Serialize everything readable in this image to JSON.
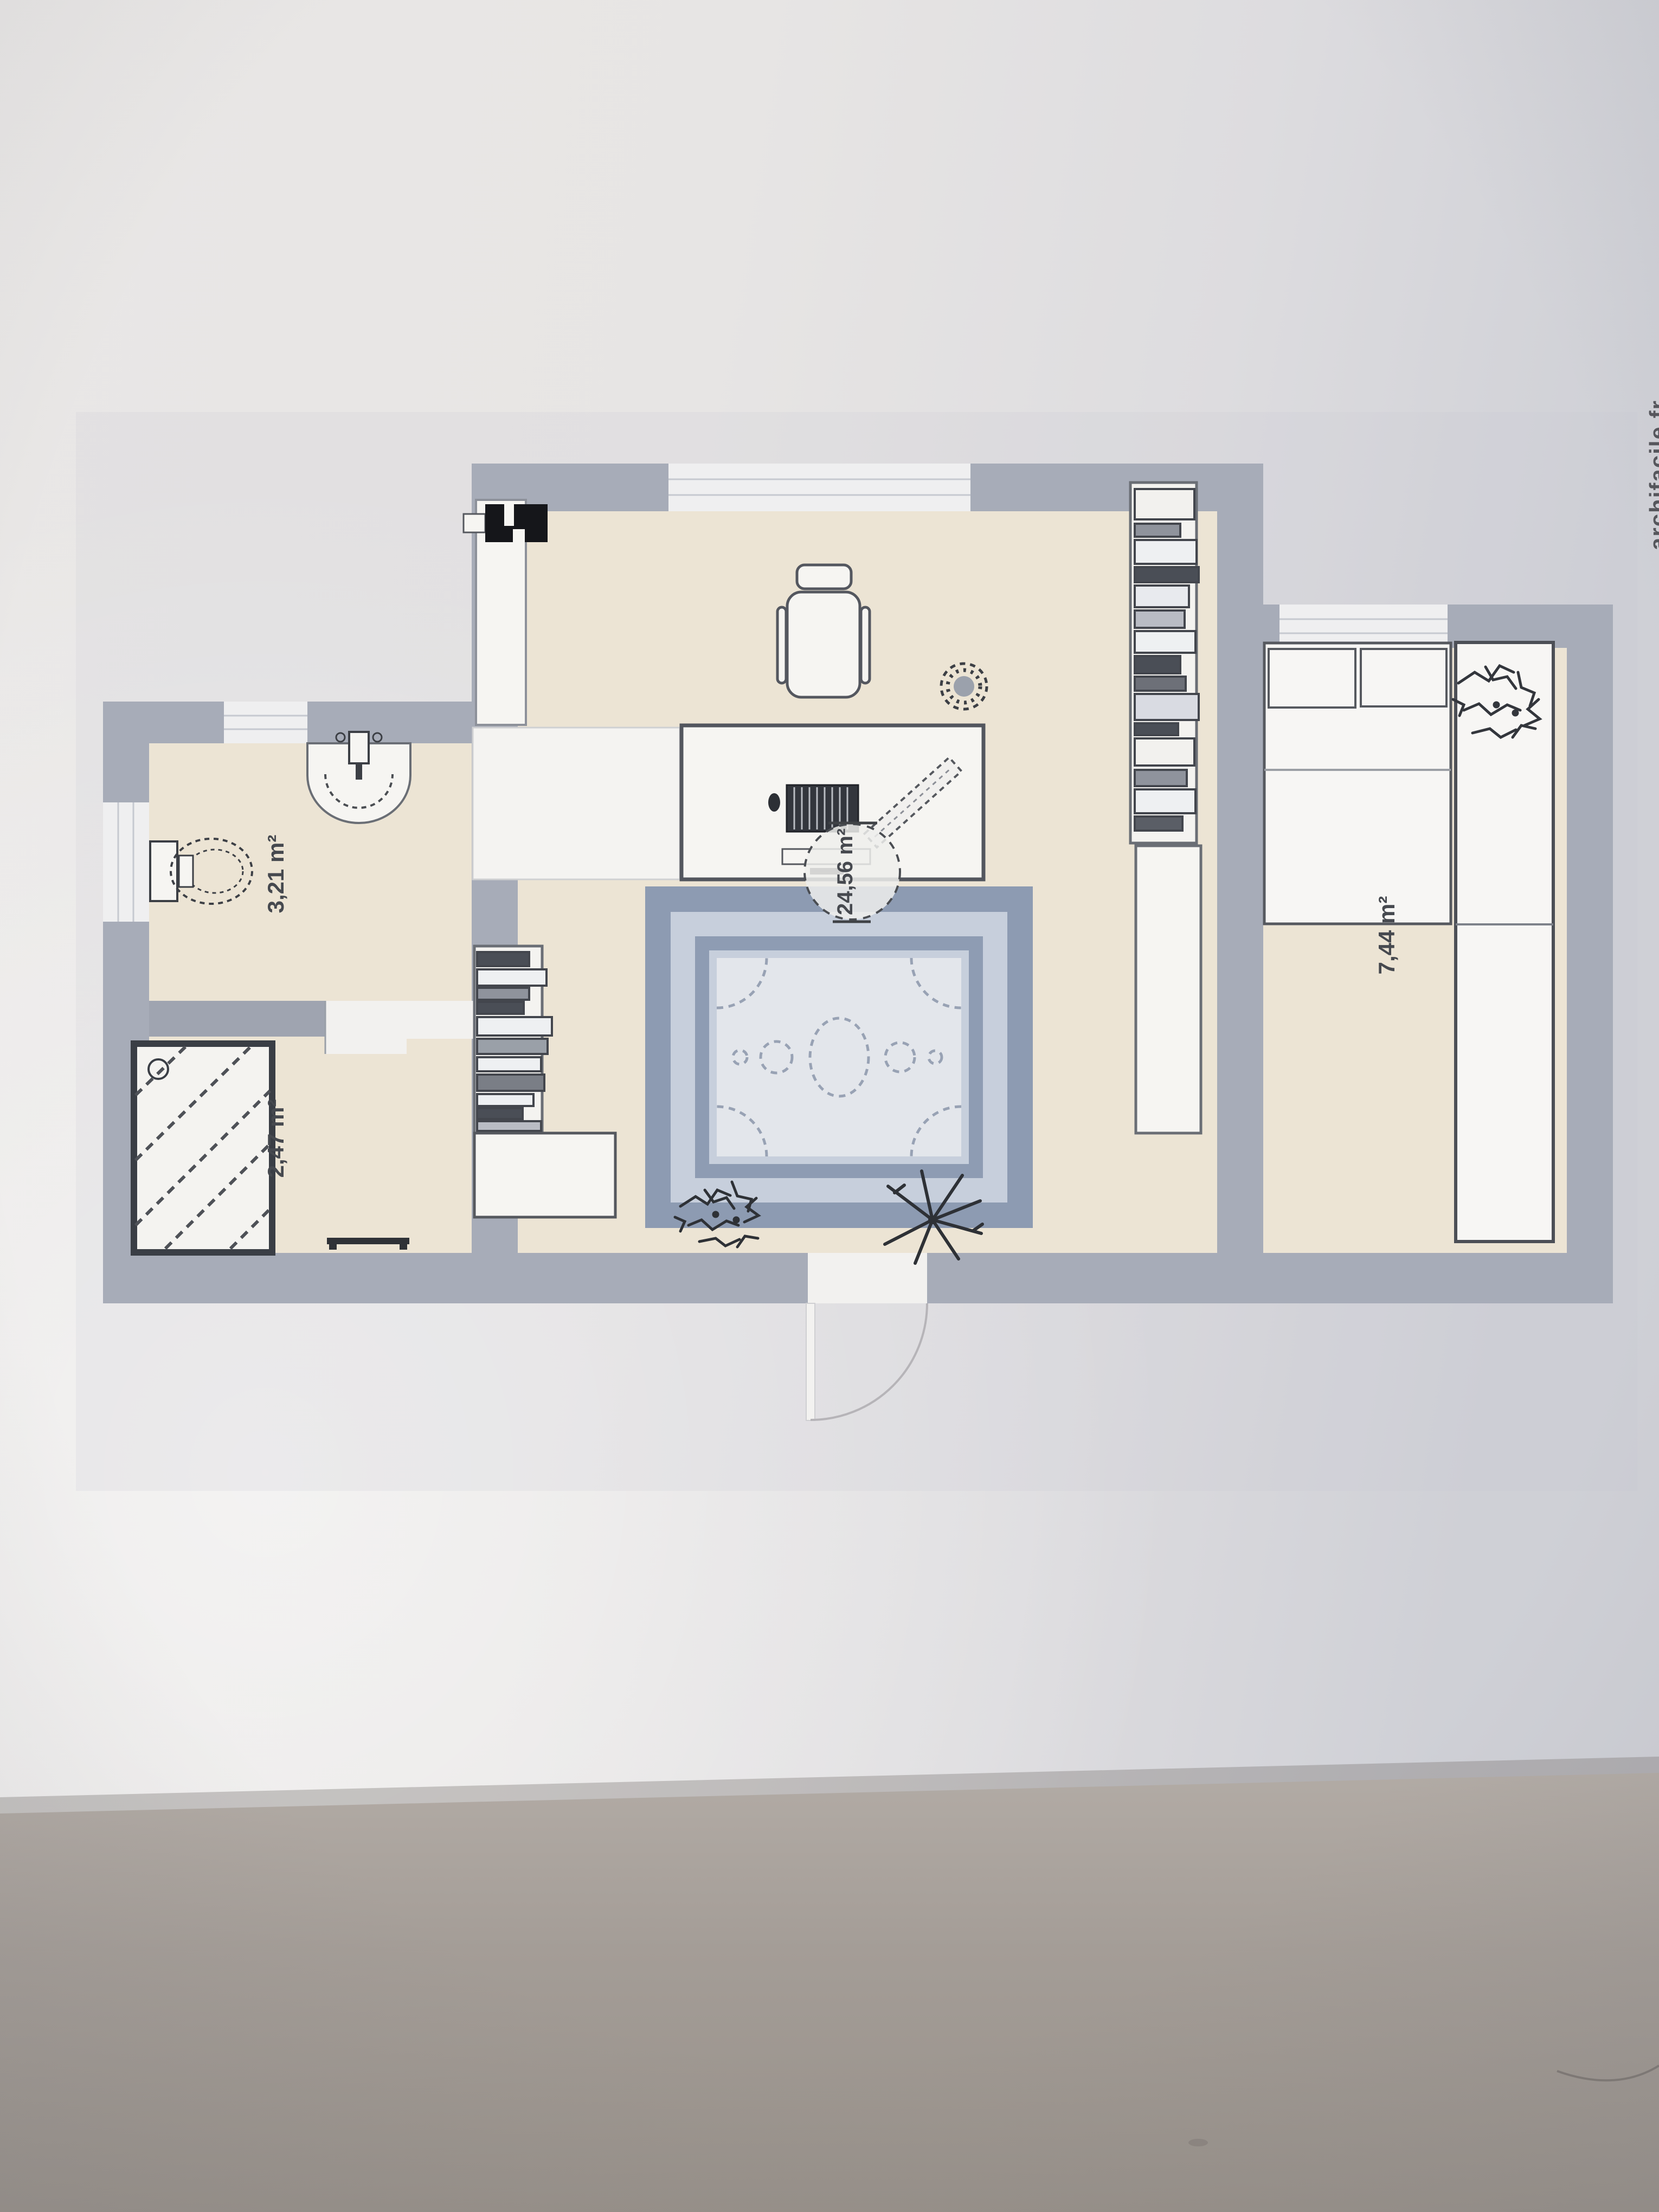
{
  "floor_plan": {
    "labels": {
      "living": "24,56 m²",
      "bathroom": "3,21 m²",
      "shower": "2,47 m²",
      "bedroom": "7,44 m²"
    },
    "watermark": "archifacile.fr",
    "rooms": [
      {
        "name": "living-room",
        "area_m2": 24.56
      },
      {
        "name": "bathroom",
        "area_m2": 3.21
      },
      {
        "name": "shower-room",
        "area_m2": 2.47
      },
      {
        "name": "bedroom",
        "area_m2": 7.44
      }
    ],
    "icons": [
      "tv-icon",
      "wardrobe-icon",
      "desk-icon",
      "office-chair-icon",
      "keyboard-icon",
      "monitor-icon",
      "mouse-icon",
      "ruler-icon",
      "fan-plant-icon",
      "bookshelf-icon",
      "cabinet-icon",
      "rug-icon",
      "plant-icon",
      "sink-icon",
      "toilet-icon",
      "shower-icon",
      "bench-icon",
      "bed-icon",
      "pillow-icon",
      "door-arc-icon"
    ],
    "colors": {
      "wall": "#a7acb8",
      "floor": "#ece4d4",
      "rug_border": "#8d9bb2",
      "rug_band": "#c7cfdc",
      "rug_center": "#e3e6eb",
      "outline": "#5d6169",
      "paper": "#e7e5e4",
      "table": "#a49d97",
      "label_text": "#46494f"
    }
  }
}
